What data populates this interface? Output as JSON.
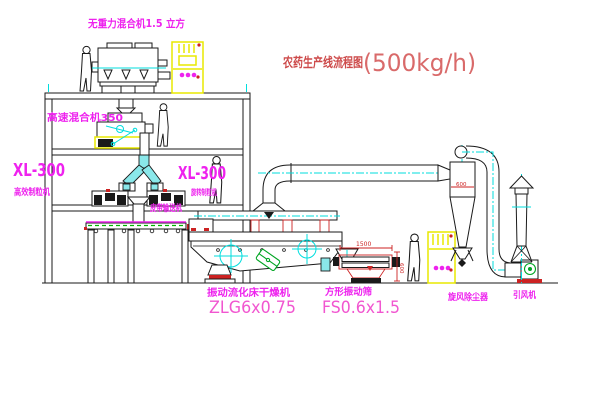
{
  "title": {
    "name": "农药生产线流程图",
    "capacity": "(500kg/h)"
  },
  "labels": {
    "top_mixer": "无重力混合机1.5 立方",
    "floor2_mixer": "高速混合机350",
    "granulator_left_model": "XL-300",
    "granulator_left_name": "高效制粒机",
    "granulator_right_model": "XL-300",
    "granulator_right_name": "旋转制粒机",
    "belt_conveyor": "皮带输送机",
    "dryer_name": "振动流化床干燥机",
    "dryer_model": "ZLG6x0.75",
    "screen_name": "方形振动筛",
    "screen_model": "FS0.6x1.5",
    "cyclone_name": "旋风除尘器",
    "fan_name": "引风机"
  },
  "dimensions": {
    "screen_length": "1500",
    "screen_height": "600",
    "cyclone_diameter": "600"
  },
  "colors": {
    "label_magenta": "#ee22ee",
    "model_pink": "#f156d0",
    "title_red": "#cd4a4a",
    "centerline_cyan": "#00dede",
    "cabinet_yellow": "#e8e800",
    "accent_red": "#cc2222",
    "motor_green": "#00a522",
    "belt_green": "#00b400",
    "duct_fill": "#8ae8ea"
  }
}
